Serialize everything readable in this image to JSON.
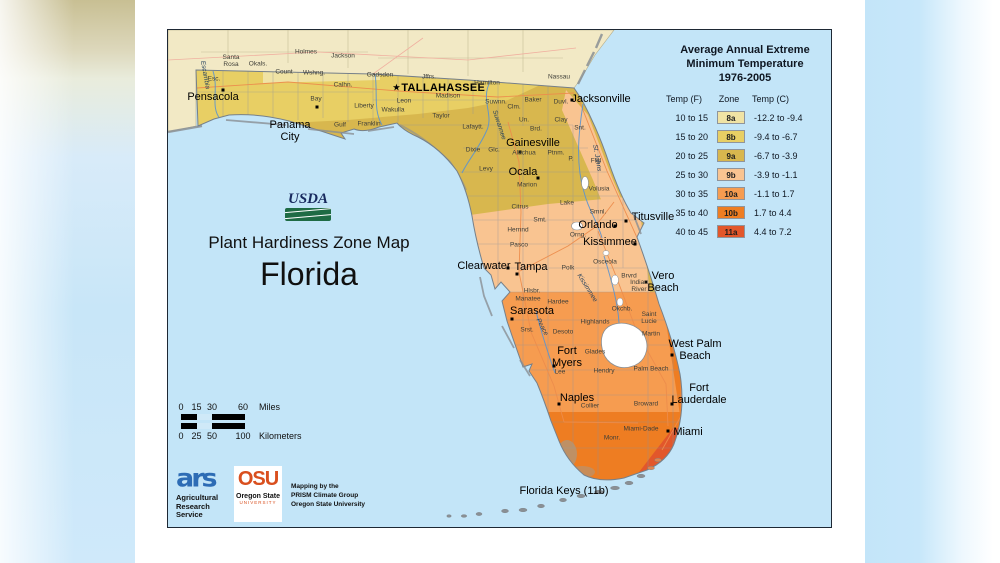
{
  "page": {
    "background": "#ffffff",
    "side_band_blue": "#c7e7fa"
  },
  "map": {
    "water_color": "#c3e5f8",
    "outside_land_color": "#f2e9c5",
    "border_color": "#1e2834",
    "title_block": {
      "usda": "USDA",
      "line1": "Plant Hardiness Zone Map",
      "line2": "Florida"
    },
    "legend": {
      "title_lines": [
        "Average Annual Extreme",
        "Minimum Temperature",
        "1976-2005"
      ],
      "columns": [
        "Temp (F)",
        "Zone",
        "Temp (C)"
      ],
      "rows": [
        {
          "f": "10 to 15",
          "zone": "8a",
          "c": "-12.2 to -9.4",
          "color": "#f0e3a4"
        },
        {
          "f": "15 to 20",
          "zone": "8b",
          "c": "-9.4 to -6.7",
          "color": "#e8cf64"
        },
        {
          "f": "20 to 25",
          "zone": "9a",
          "c": "-6.7 to -3.9",
          "color": "#d8b74e"
        },
        {
          "f": "25 to 30",
          "zone": "9b",
          "c": "-3.9 to -1.1",
          "color": "#f9c491"
        },
        {
          "f": "30 to 35",
          "zone": "10a",
          "c": "-1.1 to 1.7",
          "color": "#f69c50"
        },
        {
          "f": "35 to 40",
          "zone": "10b",
          "c": "1.7 to 4.4",
          "color": "#ee7d22"
        },
        {
          "f": "40 to 45",
          "zone": "11a",
          "c": "4.4 to 7.2",
          "color": "#e2572b"
        }
      ]
    },
    "scale_bar": {
      "miles_ticks": [
        "0",
        "15",
        "30",
        "60"
      ],
      "miles_label": "Miles",
      "km_ticks": [
        "0",
        "25",
        "50",
        "100"
      ],
      "km_label": "Kilometers"
    },
    "credits": {
      "ars_logo": "ars",
      "ars_lines": [
        "Agricultural",
        "Research",
        "Service"
      ],
      "osu_acronym": "OSU",
      "osu_name": "Oregon State",
      "osu_sub": "UNIVERSITY",
      "mapping_lines": [
        "Mapping by the",
        "PRISM Climate Group",
        "Oregon State University"
      ]
    },
    "keys_label": {
      "text": "Florida Keys (11b)",
      "x": 396,
      "y": 461
    },
    "cities": [
      {
        "text": "Pensacola",
        "x": 45,
        "y": 68,
        "marker": [
          55,
          60
        ]
      },
      {
        "text": "Panama\nCity",
        "x": 122,
        "y": 102,
        "marker": [
          149,
          77
        ]
      },
      {
        "text": "TALLAHASSEE",
        "x": 271,
        "y": 59,
        "bold": true,
        "star": true
      },
      {
        "text": "Jacksonville",
        "x": 433,
        "y": 70,
        "marker": [
          404,
          70
        ]
      },
      {
        "text": "Gainesville",
        "x": 365,
        "y": 114,
        "marker": [
          352,
          122
        ]
      },
      {
        "text": "Ocala",
        "x": 355,
        "y": 143,
        "marker": [
          370,
          148
        ]
      },
      {
        "text": "Orlando",
        "x": 430,
        "y": 196,
        "marker": [
          447,
          196
        ]
      },
      {
        "text": "Titusville",
        "x": 485,
        "y": 188,
        "marker": [
          458,
          191
        ]
      },
      {
        "text": "Kissimmee",
        "x": 442,
        "y": 213,
        "marker": [
          467,
          214
        ]
      },
      {
        "text": "Clearwater",
        "x": 316,
        "y": 237,
        "marker": [
          340,
          238
        ]
      },
      {
        "text": "Tampa",
        "x": 363,
        "y": 238,
        "marker": [
          349,
          244
        ]
      },
      {
        "text": "Vero\nBeach",
        "x": 495,
        "y": 253,
        "marker": [
          478,
          252
        ]
      },
      {
        "text": "Sarasota",
        "x": 364,
        "y": 282,
        "marker": [
          344,
          289
        ]
      },
      {
        "text": "Fort\nMyers",
        "x": 399,
        "y": 328,
        "marker": [
          386,
          336
        ]
      },
      {
        "text": "West Palm\nBeach",
        "x": 527,
        "y": 321,
        "marker": [
          504,
          325
        ]
      },
      {
        "text": "Fort\nLauderdale",
        "x": 531,
        "y": 365,
        "marker": [
          504,
          374
        ]
      },
      {
        "text": "Naples",
        "x": 409,
        "y": 369,
        "marker": [
          391,
          374
        ]
      },
      {
        "text": "Miami",
        "x": 520,
        "y": 403,
        "marker": [
          500,
          401
        ]
      }
    ],
    "counties": [
      [
        "Esc.",
        46,
        50
      ],
      [
        "Santa\nRosa",
        63,
        32
      ],
      [
        "Okals.",
        90,
        35
      ],
      [
        "Count",
        116,
        43
      ],
      [
        "Holmes",
        138,
        23
      ],
      [
        "Wshng.",
        146,
        44
      ],
      [
        "Jackson",
        175,
        27
      ],
      [
        "Gadsden",
        212,
        46
      ],
      [
        "Calhn.",
        175,
        56
      ],
      [
        "Liberty",
        196,
        77
      ],
      [
        "Bay",
        148,
        70
      ],
      [
        "Gulf",
        172,
        96
      ],
      [
        "Franklin",
        201,
        95
      ],
      [
        "Wakulla",
        225,
        81
      ],
      [
        "Leon",
        236,
        72
      ],
      [
        "Jffrs.",
        261,
        48
      ],
      [
        "Madison",
        280,
        67
      ],
      [
        "Hamilton",
        319,
        54
      ],
      [
        "Taylor",
        273,
        87
      ],
      [
        "Suwnn.",
        328,
        73
      ],
      [
        "Clm.",
        346,
        78
      ],
      [
        "Baker",
        365,
        71
      ],
      [
        "Nassau",
        391,
        48
      ],
      [
        "Duvl.",
        393,
        73
      ],
      [
        "Un.",
        356,
        91
      ],
      [
        "Brd.",
        368,
        100
      ],
      [
        "Clay",
        393,
        91
      ],
      [
        "Snt.",
        412,
        99
      ],
      [
        "Lafaytt.",
        305,
        98
      ],
      [
        "Dixie",
        305,
        121
      ],
      [
        "Glc.",
        326,
        121
      ],
      [
        "Alachua",
        356,
        124
      ],
      [
        "Ptnm.",
        388,
        124
      ],
      [
        "P.",
        403,
        130
      ],
      [
        "Flgl",
        428,
        132
      ],
      [
        "Levy",
        318,
        140
      ],
      [
        "Marion",
        359,
        156
      ],
      [
        "Volusia",
        431,
        160
      ],
      [
        "Lake",
        399,
        174
      ],
      [
        "Citrus",
        352,
        178
      ],
      [
        "Smt.",
        372,
        191
      ],
      [
        "Hernnd",
        350,
        201
      ],
      [
        "Pasco",
        351,
        216
      ],
      [
        "Smnl.",
        430,
        183
      ],
      [
        "Orng.",
        410,
        206
      ],
      [
        "Polk",
        400,
        239
      ],
      [
        "Osceola",
        437,
        233
      ],
      [
        "Brvrd",
        461,
        247
      ],
      [
        "Indian\nRiver",
        471,
        257
      ],
      [
        "Hlsbr.",
        364,
        262
      ],
      [
        "Manatee",
        360,
        270
      ],
      [
        "Hardee",
        390,
        273
      ],
      [
        "Okchb.",
        454,
        280
      ],
      [
        "Saint\nLucie",
        481,
        289
      ],
      [
        "Highlands",
        427,
        293
      ],
      [
        "Srst.",
        359,
        301
      ],
      [
        "Desoto",
        395,
        303
      ],
      [
        "Martin",
        483,
        305
      ],
      [
        "Glades",
        427,
        323
      ],
      [
        "Lee",
        392,
        343
      ],
      [
        "Hendry",
        436,
        342
      ],
      [
        "Palm Beach",
        483,
        340
      ],
      [
        "Collier",
        422,
        377
      ],
      [
        "Broward",
        478,
        375
      ],
      [
        "Miami-Dade",
        473,
        400
      ],
      [
        "Monr.",
        444,
        409
      ]
    ],
    "rivers": [
      [
        "Escambia",
        37,
        45,
        80
      ],
      [
        "Suwannee",
        331,
        95,
        72
      ],
      [
        "St. Johns",
        429,
        128,
        80
      ],
      [
        "Peace",
        374,
        297,
        62
      ],
      [
        "Kissimmee",
        419,
        258,
        58
      ]
    ]
  }
}
